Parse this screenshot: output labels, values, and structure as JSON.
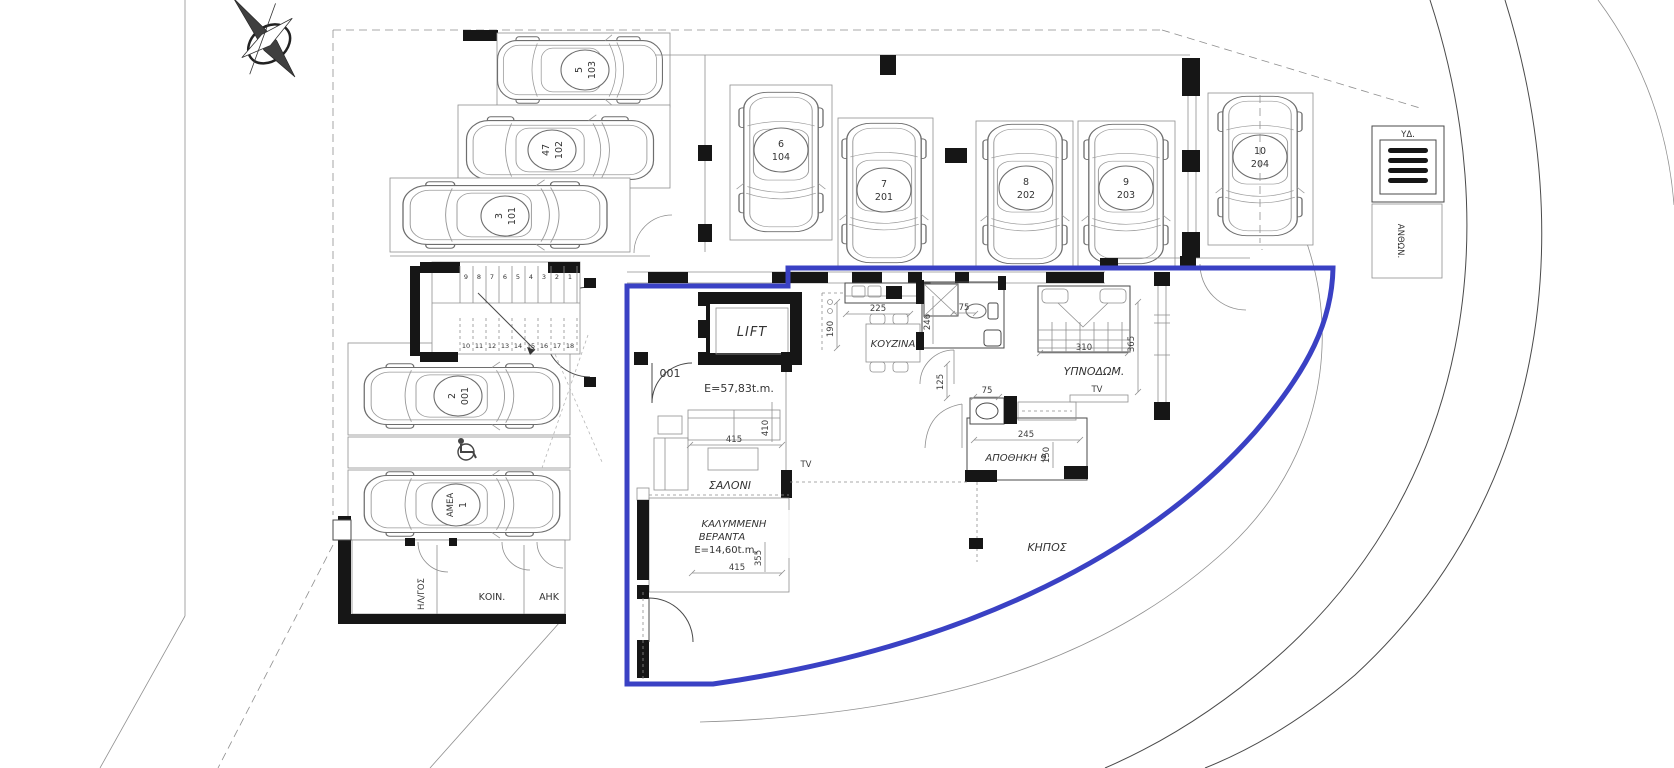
{
  "title": "ground-floor-plan",
  "colors": {
    "outline_blue": "#3a41c4",
    "ink": "#3c3c3c"
  },
  "cars": [
    {
      "spot": "5",
      "unit": "103"
    },
    {
      "spot": "47",
      "unit": "102"
    },
    {
      "spot": "3",
      "unit": "101"
    },
    {
      "spot": "6",
      "unit": "104"
    },
    {
      "spot": "7",
      "unit": "201"
    },
    {
      "spot": "8",
      "unit": "202"
    },
    {
      "spot": "9",
      "unit": "203"
    },
    {
      "spot": "10",
      "unit": "204"
    },
    {
      "spot": "2",
      "unit": "001"
    },
    {
      "spot": "1",
      "unit": "ΑΜΕΑ"
    }
  ],
  "stairs": {
    "upper": [
      "9",
      "8",
      "7",
      "6",
      "5",
      "4",
      "3",
      "2",
      "1"
    ],
    "lower": [
      "10",
      "11",
      "12",
      "13",
      "14",
      "15",
      "16",
      "17",
      "18"
    ]
  },
  "labels": {
    "lift": "LIFT",
    "entrance_code": "001",
    "unit_area": "E=57,83t.m.",
    "kitchen": "ΚΟΥΖΙΝΑ",
    "bedroom": "ΥΠΝΟΔΩΜ.",
    "storage": "ΑΠΟΘΗΚΗ 9",
    "living": "ΣΑΛΟΝΙ",
    "veranda_1": "ΚΑΛΥΜΜΕΝΗ",
    "veranda_2": "ΒΕΡΑΝΤΑ",
    "veranda_area": "E=14,60t.m.",
    "garden": "ΚΗΠΟΣ",
    "planter": "ΑΝΘΩΝ.",
    "water_meter": "ΥΔ.",
    "electrical": "ΗΛ/ΓΟΣ",
    "communal": "ΚΟΙΝ.",
    "ahk": "ΑΗΚ",
    "tv_bedroom": "TV",
    "tv_living": "TV"
  },
  "dimensions": {
    "kitchen_width": "225",
    "kitchen_depth": "190",
    "bath_depth": "246",
    "bath_width": "75",
    "hall_width": "125",
    "storage_door": "75",
    "storage_width": "245",
    "storage_depth": "150",
    "bedroom_width": "310",
    "bedroom_depth": "365",
    "living_width": "415",
    "living_depth": "410",
    "veranda_width": "415",
    "veranda_depth": "355"
  }
}
